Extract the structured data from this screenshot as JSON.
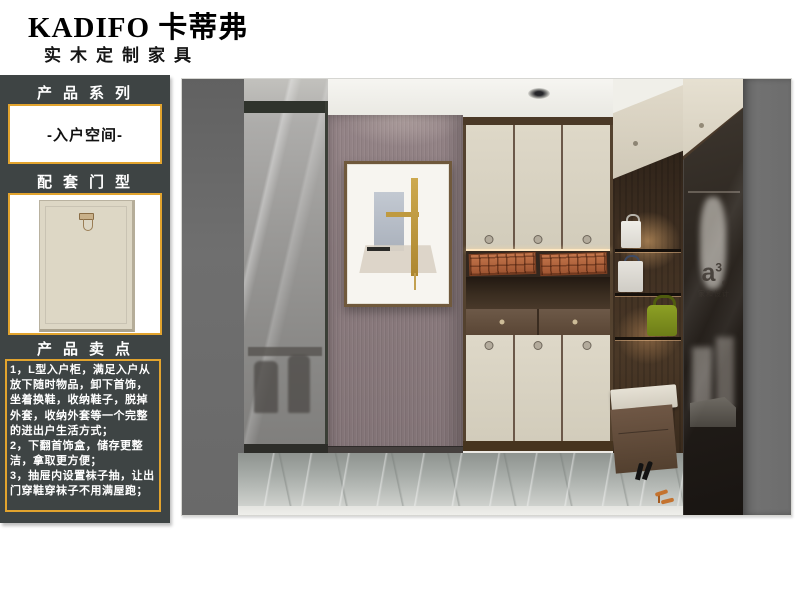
{
  "brand": {
    "name": "KADIFO 卡蒂弗",
    "tagline": "实木定制家具"
  },
  "sidebar": {
    "series_label": "产品系列",
    "series_value": "-入户空间-",
    "door_label": "配套门型",
    "selling_label": "产品卖点",
    "selling_points": [
      "1，L型入户柜，满足入户从放下随时物品，卸下首饰，坐着换鞋，收纳鞋子，脱掉外套，收纳外套等一个完整的进出户生活方式；",
      "2，下翻首饰盒，储存更整洁，拿取更方便；",
      "3，抽屉内设置袜子抽，让出门穿鞋穿袜子不用满屋跑；"
    ]
  },
  "photo": {
    "watermark_logo": "a",
    "watermark_sup": "3",
    "watermark_reg": "®",
    "watermark_text": "家和设计"
  },
  "colors": {
    "accent_border": "#e2a42e",
    "sidebar_bg": "#3e4444",
    "mauve_wall": "#8b7b7e",
    "cream_cabinet": "#d9d2c2",
    "wood_dark": "#54422f",
    "tray_terracotta": "#ad5e37",
    "bag_green": "#7d901c",
    "marble_floor": "#aab0ac"
  }
}
